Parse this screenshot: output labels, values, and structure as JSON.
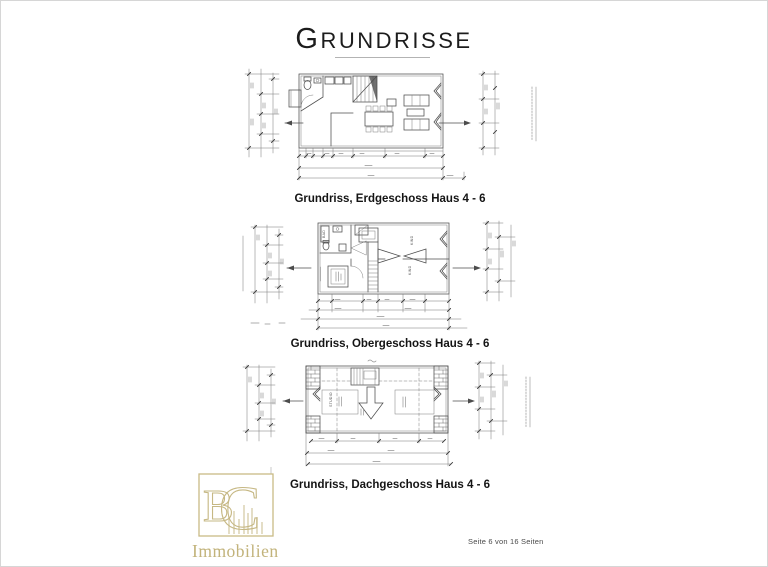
{
  "document": {
    "title": "Grundrisse",
    "footer_page_indicator": "Seite 6 von 16 Seiten"
  },
  "plans": [
    {
      "caption": "Grundriss, Erdgeschoss  Haus 4 - 6"
    },
    {
      "caption": "Grundriss, Obergeschoss Haus 4 - 6"
    },
    {
      "caption": "Grundriss, Dachgeschoss Haus 4 - 6"
    }
  ],
  "room_labels": {
    "obergeschoss": {
      "bath": "BAD",
      "child_top": "KIND",
      "child_bottom": "KIND"
    },
    "dachgeschoss": {
      "studio": "STUDIO"
    }
  },
  "logo": {
    "monogram_left": "B",
    "monogram_right": "C",
    "caption": "Immobilien"
  },
  "colors": {
    "logo_gold": "#c6b884",
    "drawing_line": "#4d4d4d"
  }
}
